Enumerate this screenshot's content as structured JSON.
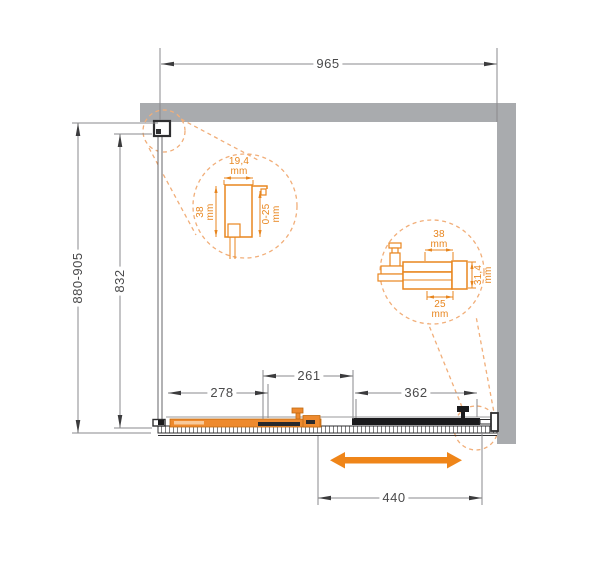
{
  "drawing": {
    "type": "shower-enclosure-plan",
    "colors": {
      "accent_orange": "#ef8519",
      "detail_orange": "#e8861f",
      "dash_orange": "#f1ae79",
      "wall_gray": "#a9abae",
      "line_dark": "#3b3b3d",
      "panel_black": "#1b1b1d",
      "dim_text": "#4a4a4b"
    }
  },
  "dimensions": {
    "total_width": "965",
    "depth_range": "880-905",
    "side_glass_depth": "832",
    "door_panel": "278",
    "overlap": "261",
    "fixed_panel": "362",
    "opening_width": "440"
  },
  "detail_left": {
    "width_value": "19,4",
    "width_unit": "mm",
    "height_value": "38",
    "height_unit": "mm",
    "adjust_value": "0-25",
    "adjust_unit": "mm"
  },
  "detail_right": {
    "width_value": "38",
    "width_unit": "mm",
    "height_value": "31,4",
    "height_unit": "mm",
    "bottom_value": "25",
    "bottom_unit": "mm"
  }
}
